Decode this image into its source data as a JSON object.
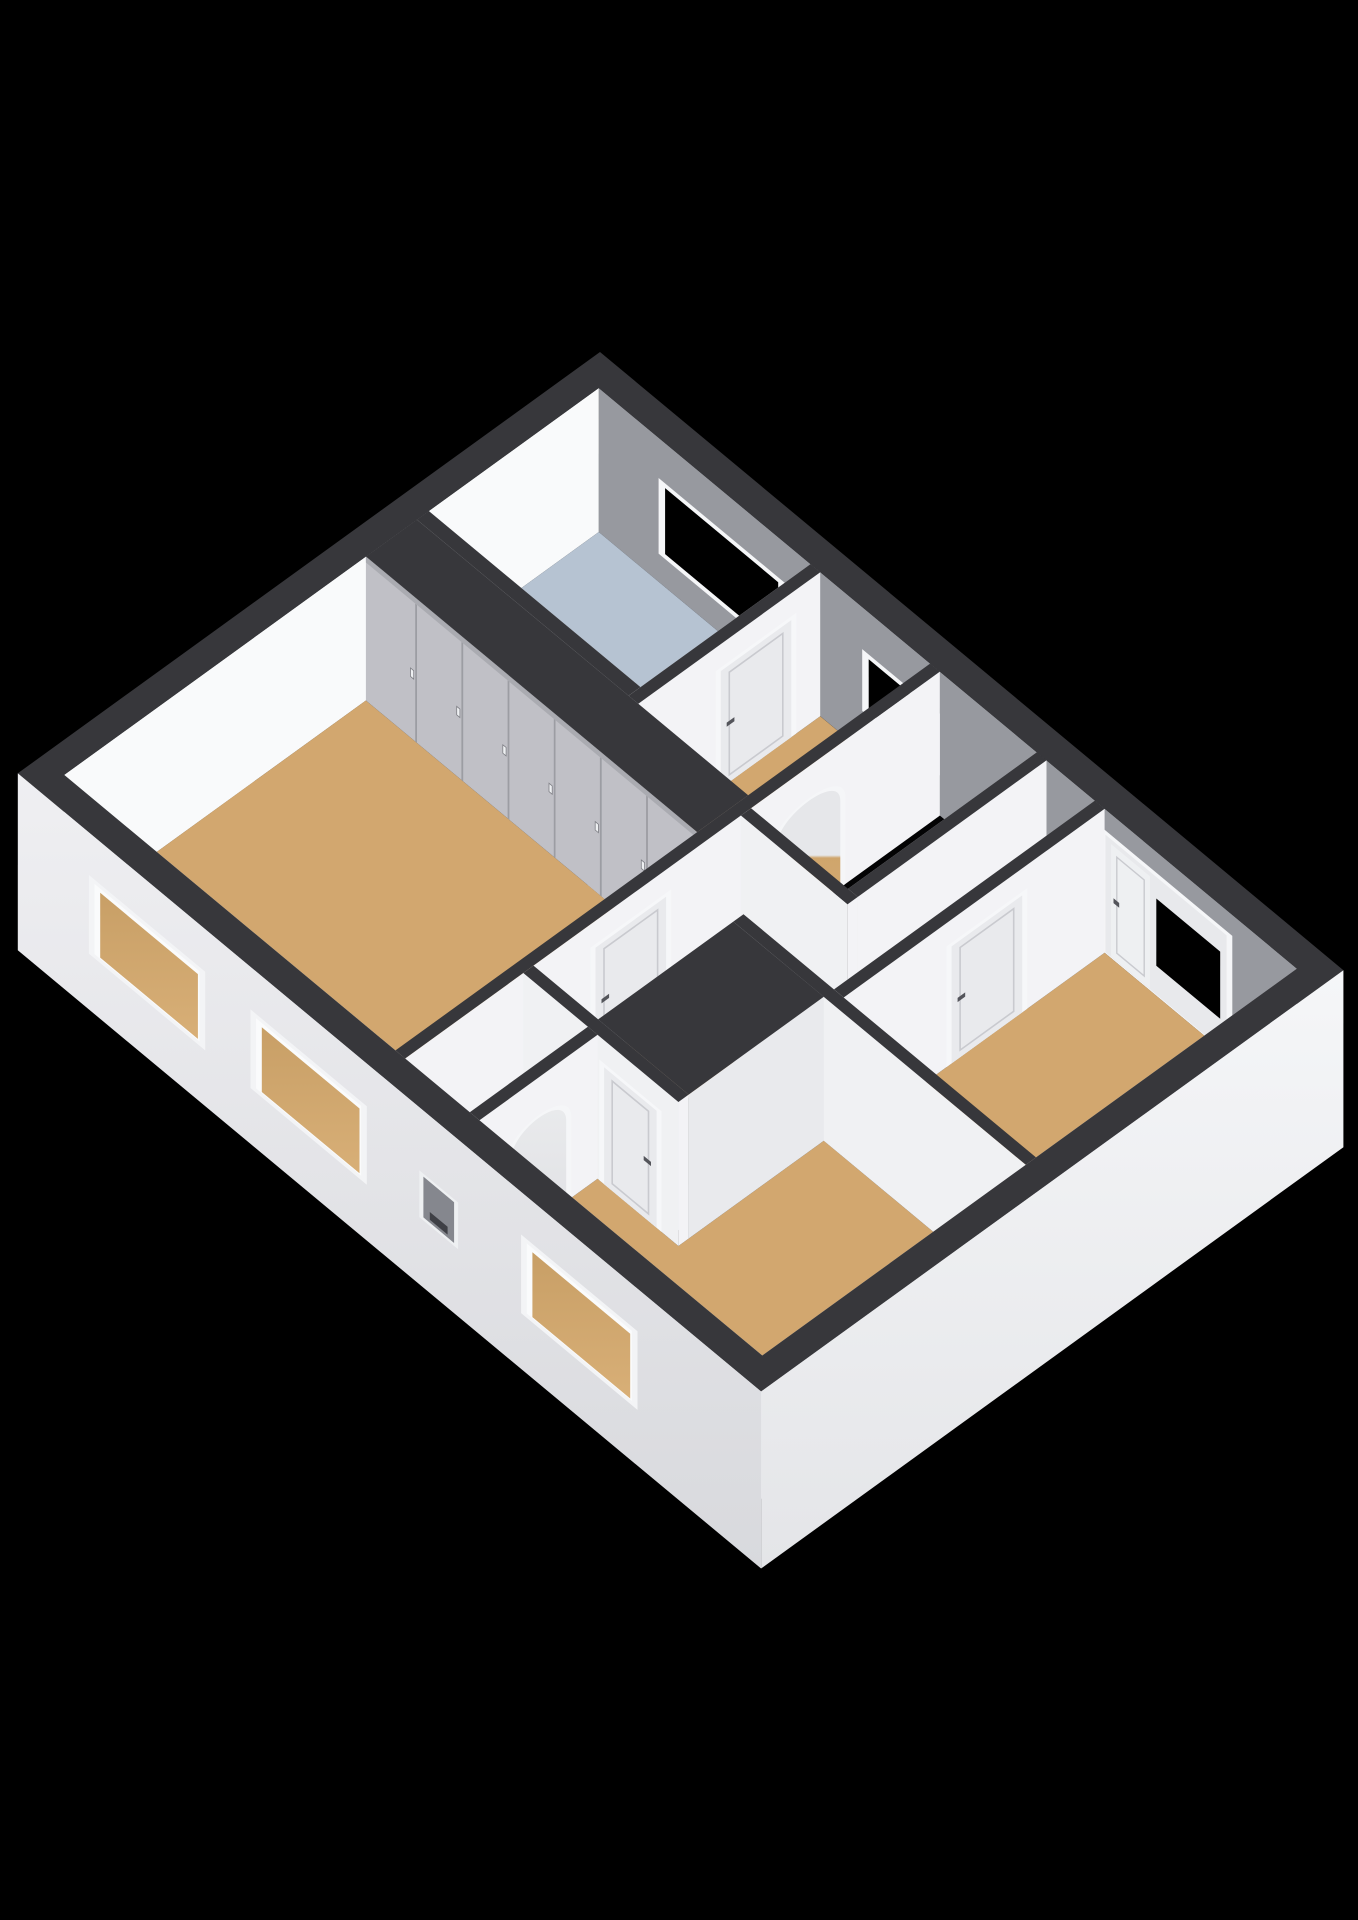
{
  "figure": {
    "kind": "3d-floor-plan-render",
    "background": "#000000",
    "width": 1358,
    "height": 1920
  },
  "scene": {
    "projection": {
      "origin": [
        600,
        496
      ],
      "ex": [
        80.8,
        67.2
      ],
      "ey": [
        -85.0,
        61.5
      ],
      "ez": 60,
      "cut_height": 2.4,
      "base_depth": -0.55
    },
    "palette": {
      "background": "#000000",
      "wall_top": "#37373b",
      "floor_wood": "#d2a76f",
      "floor_bathroom": "#b6c3d2",
      "floor_closet": "#e8e9ec",
      "stair_void": "#030304",
      "inner_ne": "#97999f",
      "inner_nw": "#f9fafb",
      "inner_se": "#c9c9ce",
      "inner_sw": "#edeef1",
      "face_bright": "#f3f3f6",
      "face_light": "#f0f1f3",
      "face_shade": "#e7e8eb",
      "wardrobe_front": "#c0c0c6",
      "wardrobe_seam": "#9c9da3",
      "door_leaf": "#e9eaed",
      "door_frame": "#f6f7f9",
      "door_panel_line": "#c9cacf",
      "handle_dark": "#54555b",
      "window_frame": "#f5f6f8",
      "glass": "#000000",
      "sink_wood": "#c79e5f",
      "sink_wood_seam": "#ab8245",
      "sink_white": "#f6f7f9",
      "basin_inner": "#dfe1e5",
      "niche_inner": "#85878e",
      "niche_slot": "#3e3f45"
    },
    "elements": [
      {
        "type": "face",
        "name": "ne-wall-inner",
        "plane": "y",
        "at": 0.28,
        "a0": 0.28,
        "a1": 8.92,
        "z0": 0,
        "z1": 2.4,
        "fill": "#97999f"
      },
      {
        "type": "window_ne",
        "name": "bathroom-window",
        "x0": 1.1,
        "x1": 2.5,
        "z0": 0.55,
        "z1": 1.65
      },
      {
        "type": "window_ne",
        "name": "landing-window",
        "x0": 3.62,
        "x1": 4.42,
        "z0": 0.75,
        "z1": 1.62
      },
      {
        "type": "combo_ne",
        "name": "bedroom3-balcony-door-window",
        "x0": 6.55,
        "x1": 8.05,
        "door_x0": 6.62,
        "door_x1": 7.1,
        "glass_x0": 7.18,
        "glass_x1": 7.97,
        "z1": 1.98,
        "glass_z0": 0.5,
        "glass_z1": 1.62
      },
      {
        "type": "face",
        "name": "nw-wall-inner",
        "plane": "x",
        "at": 0.28,
        "a0": 0.28,
        "a1": 6.57,
        "z0": 0,
        "z1": 2.4,
        "fill": "#f9fafb"
      },
      {
        "type": "floor",
        "name": "bathroom-floor",
        "fill": "#b6c3d2",
        "poly": [
          [
            0.28,
            0.28
          ],
          [
            2.9,
            0.28
          ],
          [
            2.9,
            2.28
          ],
          [
            0.28,
            2.28
          ]
        ]
      },
      {
        "type": "floor",
        "name": "corridor-north-floor",
        "fill": "#d2a76f",
        "poly": [
          [
            3.02,
            0.28
          ],
          [
            4.38,
            0.28
          ],
          [
            4.38,
            3.02
          ],
          [
            3.02,
            3.02
          ]
        ]
      },
      {
        "type": "floor",
        "name": "landing-floor",
        "fill": "#d2a76f",
        "poly": [
          [
            5.82,
            0.28
          ],
          [
            6.42,
            0.28
          ],
          [
            6.42,
            3.35
          ],
          [
            4.5,
            3.35
          ],
          [
            4.5,
            2.62
          ],
          [
            5.82,
            2.62
          ]
        ]
      },
      {
        "type": "floor",
        "name": "stairwell-void",
        "fill": "#030304",
        "poly": [
          [
            4.5,
            0.28
          ],
          [
            5.7,
            0.28
          ],
          [
            5.7,
            2.5
          ],
          [
            4.5,
            2.5
          ]
        ]
      },
      {
        "type": "floor",
        "name": "bedroom1-floor",
        "fill": "#d2a76f",
        "poly": [
          [
            0.28,
            3.02
          ],
          [
            4.38,
            3.02
          ],
          [
            4.38,
            6.57
          ],
          [
            0.28,
            6.57
          ]
        ]
      },
      {
        "type": "floor",
        "name": "bedroom3-floor",
        "fill": "#d2a76f",
        "poly": [
          [
            6.54,
            0.28
          ],
          [
            8.92,
            0.28
          ],
          [
            8.92,
            3.35
          ],
          [
            6.54,
            3.35
          ]
        ]
      },
      {
        "type": "floor",
        "name": "bedroom2-floor",
        "fill": "#d2a76f",
        "poly": [
          [
            6.42,
            3.47
          ],
          [
            8.92,
            3.47
          ],
          [
            8.92,
            6.57
          ],
          [
            5.42,
            6.57
          ],
          [
            5.42,
            5.18
          ],
          [
            6.42,
            5.18
          ]
        ]
      },
      {
        "type": "floor",
        "name": "corridor-south-floor",
        "fill": "#d2a76f",
        "poly": [
          [
            4.5,
            3.35
          ],
          [
            5.3,
            3.35
          ],
          [
            5.3,
            5.06
          ],
          [
            4.5,
            5.06
          ]
        ]
      },
      {
        "type": "floor",
        "name": "arch-closet-floor",
        "fill": "#e8e9ec",
        "poly": [
          [
            4.5,
            5.18
          ],
          [
            5.3,
            5.18
          ],
          [
            5.3,
            6.57
          ],
          [
            4.5,
            6.57
          ]
        ]
      },
      {
        "type": "face",
        "name": "se-wall-inner",
        "plane": "x",
        "at": 8.92,
        "a0": 0.28,
        "a1": 6.57,
        "z0": 0,
        "z1": 2.4,
        "fill": "#c9c9ce"
      },
      {
        "type": "face",
        "name": "sw-wall-inner",
        "plane": "y",
        "at": 6.57,
        "a0": 0.28,
        "a1": 8.92,
        "z0": 0,
        "z1": 2.4,
        "fill": "#edeef1"
      },
      {
        "type": "sink",
        "name": "bathroom-sink"
      },
      {
        "type": "box",
        "name": "wall-bathroom-south",
        "x0": 0.28,
        "y0": 2.28,
        "x1": 2.9,
        "y1": 2.42,
        "neg_y": "#eef0f2"
      },
      {
        "type": "box",
        "name": "wall-bathroom-east",
        "x0": 2.9,
        "y0": 0.28,
        "x1": 3.02,
        "y1": 2.42,
        "neg_x": "#dcdde1"
      },
      {
        "type": "door",
        "name": "bathroom-door",
        "plane": "x",
        "at": 3.02,
        "a0": 0.62,
        "a1": 1.45,
        "h": 1.95
      },
      {
        "type": "wardrobe",
        "name": "bedroom1-wardrobe",
        "x0": 0.28,
        "y0": 2.42,
        "x1": 4.38,
        "y1": 3.02,
        "panels": 7
      },
      {
        "type": "box",
        "name": "wall-landing-west",
        "x0": 4.38,
        "y0": 0.28,
        "x1": 4.5,
        "y1": 6.57
      },
      {
        "type": "arch",
        "name": "stairs-arch",
        "plane": "x",
        "at": 4.5,
        "a0": 1.45,
        "a1": 2.2,
        "zs": 1.45,
        "za": 1.95,
        "fill": "url(#gArchTan)"
      },
      {
        "type": "door",
        "name": "bedroom1-door",
        "plane": "x",
        "at": 4.5,
        "a0": 3.5,
        "a1": 4.33,
        "h": 1.95
      },
      {
        "type": "box",
        "name": "wall-stair-east",
        "x0": 5.7,
        "y0": 0.28,
        "x1": 5.82,
        "y1": 2.5,
        "neg_x": "#d9dadd"
      },
      {
        "type": "box",
        "name": "wall-stair-south",
        "x0": 4.5,
        "y0": 2.5,
        "x1": 5.82,
        "y1": 2.62
      },
      {
        "type": "box",
        "name": "wall-bedroom3-west",
        "x0": 6.42,
        "y0": 0.28,
        "x1": 6.54,
        "y1": 3.35
      },
      {
        "type": "door",
        "name": "bedroom3-door",
        "plane": "x",
        "at": 6.54,
        "a0": 1.25,
        "a1": 2.08,
        "h": 1.95
      },
      {
        "type": "box",
        "name": "wall-bedroom2-north",
        "x0": 5.3,
        "y0": 3.35,
        "x1": 8.92,
        "y1": 3.47
      },
      {
        "type": "box",
        "name": "bedroom2-closet-block",
        "x0": 5.3,
        "y0": 3.47,
        "x1": 6.42,
        "y1": 5.06,
        "fx": "#e9eaed",
        "fy": "#e2e3e6"
      },
      {
        "type": "box",
        "name": "wall-bedroom2-closet-south",
        "x0": 4.5,
        "y0": 5.06,
        "x1": 6.42,
        "y1": 5.18
      },
      {
        "type": "door",
        "name": "bedroom2-closet-door",
        "plane": "y",
        "at": 5.18,
        "a0": 5.5,
        "a1": 6.15,
        "h": 1.95
      },
      {
        "type": "box",
        "name": "wall-arch-closet-east",
        "x0": 5.3,
        "y0": 5.18,
        "x1": 5.42,
        "y1": 6.57
      },
      {
        "type": "arch",
        "name": "closet-arch",
        "plane": "x",
        "at": 5.42,
        "a0": 5.55,
        "a1": 6.2,
        "zs": 1.35,
        "za": 1.85,
        "fill": "url(#gArchLight)"
      },
      {
        "type": "ring",
        "name": "exterior-wall-top-band",
        "x0": 0,
        "y0": 0,
        "x1": 9.2,
        "y1": 6.85,
        "ix0": 0.28,
        "iy0": 0.28,
        "ix1": 8.92,
        "iy1": 6.57
      },
      {
        "type": "face",
        "name": "se-wall-outer",
        "plane": "x",
        "at": 9.2,
        "a0": 0,
        "a1": 6.85,
        "z0": -0.55,
        "z1": 2.4,
        "fill": "url(#gExtSE)"
      },
      {
        "type": "face",
        "name": "sw-wall-outer",
        "plane": "y",
        "at": 6.85,
        "a0": 0,
        "a1": 9.2,
        "z0": -0.55,
        "z1": 2.4,
        "fill": "url(#gExtSW)"
      },
      {
        "type": "window_sw",
        "name": "bedroom1-window-1",
        "x0": 0.95,
        "x1": 2.25,
        "z0": 0.45,
        "z1": 1.62
      },
      {
        "type": "window_sw",
        "name": "bedroom1-window-2",
        "x0": 2.95,
        "x1": 4.25,
        "z0": 0.45,
        "z1": 1.62
      },
      {
        "type": "window_sw",
        "name": "bedroom2-window",
        "x0": 6.3,
        "x1": 7.6,
        "z0": 0.45,
        "z1": 1.62
      },
      {
        "type": "niche",
        "name": "facade-niche",
        "x0": 5.02,
        "x1": 5.4,
        "z0": 0.62,
        "z1": 1.3
      }
    ]
  }
}
